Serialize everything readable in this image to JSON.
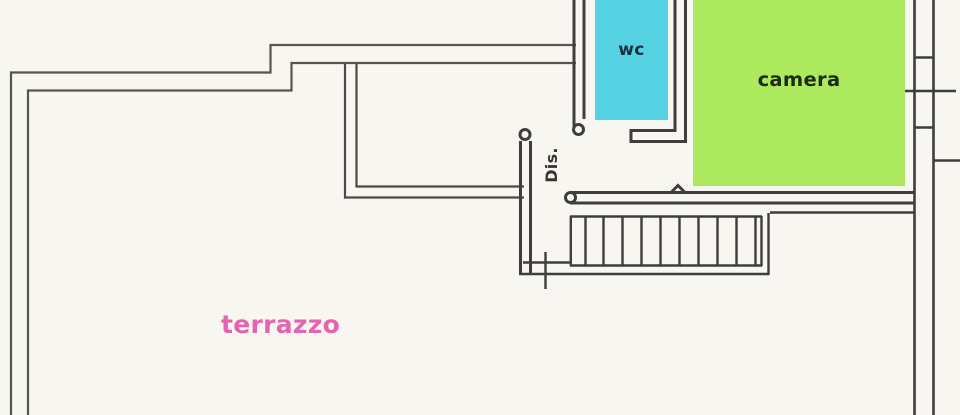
{
  "floorplan": {
    "rooms": {
      "wc": {
        "label": "wc",
        "fill": "#55d1e2",
        "label_color": "#16303d"
      },
      "camera": {
        "label": "camera",
        "fill": "#ace95c",
        "label_color": "#1c2b12"
      },
      "dis": {
        "label": "Dis.",
        "label_color": "#35332e"
      },
      "terrazzo": {
        "label": "terrazzo",
        "label_color": "#e564af"
      }
    },
    "colors": {
      "paper": "#f7f6f1",
      "wall_lines": "#3f3e3a",
      "parapet_lines": "#57554f"
    }
  }
}
